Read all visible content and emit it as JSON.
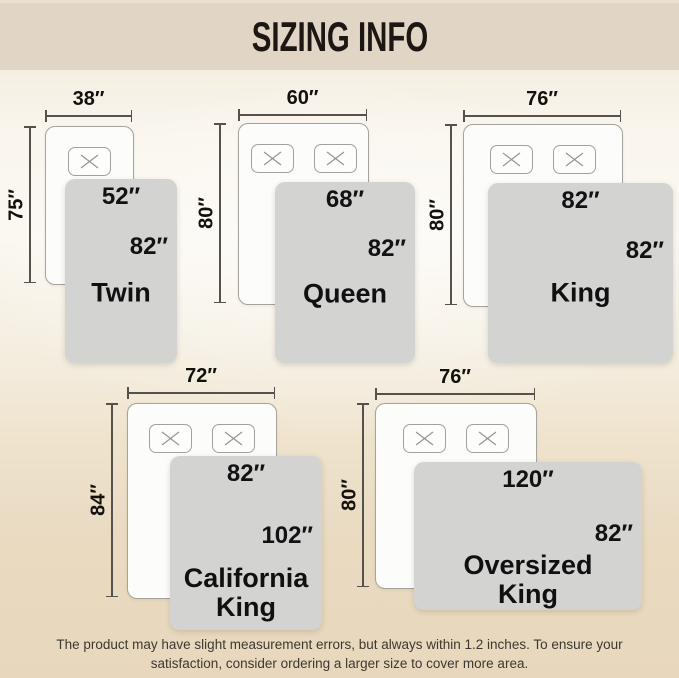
{
  "title": "SIZING INFO",
  "footer": {
    "text": "The product may have slight measurement errors, but always within 1.2 inches. To ensure your\nsatisfaction, consider ordering a larger size to cover more area."
  },
  "colors": {
    "header_bg": "#e1d6c5",
    "header_text": "#1c1712",
    "bed_fill": "#fcfcfa",
    "bed_border": "#a5a39b",
    "blanket_fill": "#d3d3d2",
    "dim_line": "#55514b",
    "label_text": "#121212",
    "footer_text": "#3d3830"
  },
  "sizes": [
    {
      "name": "Twin",
      "pillows": 1,
      "bed": {
        "width": "38″",
        "height": "75″"
      },
      "blanket": {
        "width": "52″",
        "height": "82″"
      },
      "pos": {
        "bed": [
          45,
          126,
          87,
          157
        ],
        "blanket": [
          65,
          179,
          112,
          184
        ],
        "wdim_y": 116,
        "hdim_x": 30,
        "hlabel_cy": 0.375,
        "name_cy": 0.62
      }
    },
    {
      "name": "Queen",
      "pillows": 2,
      "bed": {
        "width": "60″",
        "height": "80″"
      },
      "blanket": {
        "width": "68″",
        "height": "82″"
      },
      "pos": {
        "bed": [
          238,
          123,
          129,
          180
        ],
        "blanket": [
          275,
          182,
          140,
          181
        ],
        "wdim_y": 115,
        "hdim_x": 220,
        "hlabel_cy": 0.376,
        "name_cy": 0.62
      }
    },
    {
      "name": "King",
      "pillows": 2,
      "bed": {
        "width": "76″",
        "height": "80″"
      },
      "blanket": {
        "width": "82″",
        "height": "82″"
      },
      "pos": {
        "bed": [
          463,
          124,
          158,
          181
        ],
        "blanket": [
          488,
          183,
          185,
          180
        ],
        "wdim_y": 116,
        "hdim_x": 451,
        "hlabel_cy": 0.383,
        "name_cy": 0.61
      }
    },
    {
      "name": "California\nKing",
      "pillows": 2,
      "bed": {
        "width": "72″",
        "height": "84″"
      },
      "blanket": {
        "width": "82″",
        "height": "102″"
      },
      "pos": {
        "bed": [
          127,
          403,
          148,
          194
        ],
        "blanket": [
          170,
          456,
          152,
          174
        ],
        "wdim_y": 393,
        "hdim_x": 112,
        "hlabel_cy": 0.465,
        "name_cy": 0.79
      }
    },
    {
      "name": "Oversized\nKing",
      "pillows": 2,
      "bed": {
        "width": "76″",
        "height": "80″"
      },
      "blanket": {
        "width": "120″",
        "height": "82″"
      },
      "pos": {
        "bed": [
          375,
          403,
          160,
          184
        ],
        "blanket": [
          414,
          462,
          228,
          148
        ],
        "wdim_y": 394,
        "hdim_x": 363,
        "hlabel_cy": 0.49,
        "name_cy": 0.8
      }
    }
  ]
}
